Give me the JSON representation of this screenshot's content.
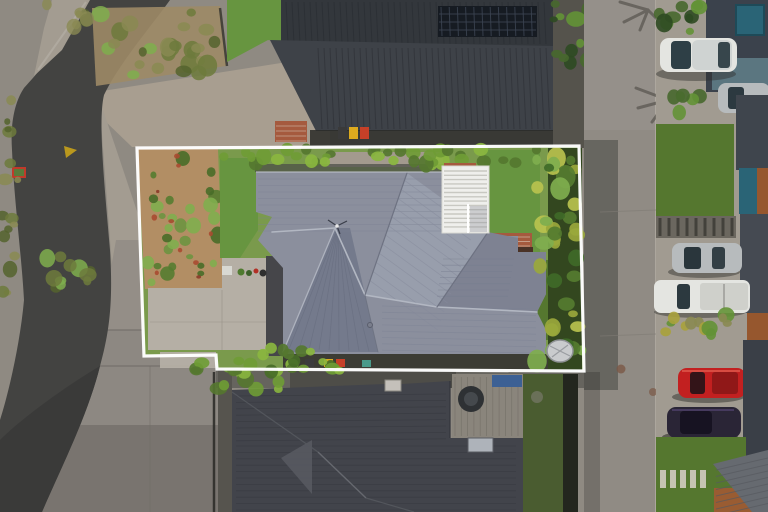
{
  "meta": {
    "type": "aerial-drone-photograph",
    "subject": "residential-property-with-white-boundary-outline",
    "width": 768,
    "height": 512
  },
  "scene": {
    "boundary_points": "137,148 579,146 584,371 217,369 216,355 144,356",
    "objects": [
      "property-boundary-outline",
      "main-house-hip-roof",
      "white-louvre-pergola",
      "concrete-driveway",
      "mulch-garden-bed",
      "lawn",
      "tropical-garden-border",
      "top-neighbor-roof-with-solar-panels",
      "bottom-neighbor-roof",
      "patio-deck",
      "spa",
      "skylight",
      "vertical-street",
      "curving-road",
      "white-hatchback",
      "silver-suv",
      "silver-sedan",
      "white-pickup",
      "red-car",
      "dark-purple-car",
      "swimming-pool",
      "wheelie-bins",
      "palm-tree-shadows",
      "paver-steps",
      "yellow-road-marking",
      "tarp-covered-object",
      "antenna",
      "brick-patio"
    ]
  },
  "colors": {
    "base": "#8f8a82",
    "road": "#434341",
    "road_dark": "#3a3a39",
    "slabs": "#8d8882",
    "wedge": "#a89e90",
    "footpath": "#a39c91",
    "lawn_bright": "#679540",
    "lawn_mid": "#55772f",
    "lawn_olive": "#4a5c30",
    "scrub_tan": "#9d8a66",
    "mulch": "#b28e64",
    "roof_main": "#8b8f9d",
    "roof_main_dark": "#747a8c",
    "roof_main_light": "#989eac",
    "ridge_light": "#b2b7c2",
    "top_roof_upper": "#33373c",
    "top_roof_lower": "#3e4248",
    "solar": "#161b22",
    "bottom_roof": "#42444b",
    "pergola": "#efefec",
    "brick": "#a55a3e",
    "pool": "#2a6476",
    "deck": "#8a857c",
    "street": "#908b84",
    "drive_right": "#a19b91",
    "fence_dark": "#2e2f28",
    "asphalt_court": "#46464a",
    "car_white": "#e4e5e1",
    "car_silver": "#b7bbbd",
    "car_red": "#c22020",
    "car_dark": "#2a2536",
    "tarp": "#c9cbcd",
    "boundary": "#ffffff",
    "bin_yellow": "#ddaa1e",
    "bin_red": "#c64028",
    "bin_teal": "#4a9a8a",
    "bin_blue": "#3c6094",
    "marking_yellow": "#c8a21a",
    "eave_shadow": "#3c3c34",
    "driveway_lot": "#b5afa5"
  }
}
